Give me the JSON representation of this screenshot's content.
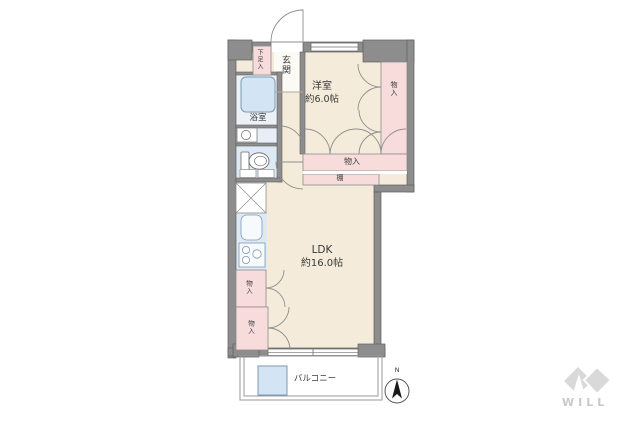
{
  "labels": {
    "entrance": "玄関",
    "shoe_storage": "下足入",
    "bathroom": "浴室",
    "western_room_name": "洋室",
    "western_room_size": "約6.0帖",
    "ldk_name": "LDK",
    "ldk_size": "約16.0帖",
    "storage": "物入",
    "shelf": "棚",
    "balcony": "バルコニー",
    "compass_north": "N",
    "brand": "WILL"
  },
  "colors": {
    "wall": "#8d8d8d",
    "floor_cream": "#f4ebda",
    "closet_pink": "#f8dbdb",
    "wet_area_blue": "#dde9f4",
    "fixture_blue": "#d3e5f4",
    "logo_gray": "#d9d9d9"
  }
}
